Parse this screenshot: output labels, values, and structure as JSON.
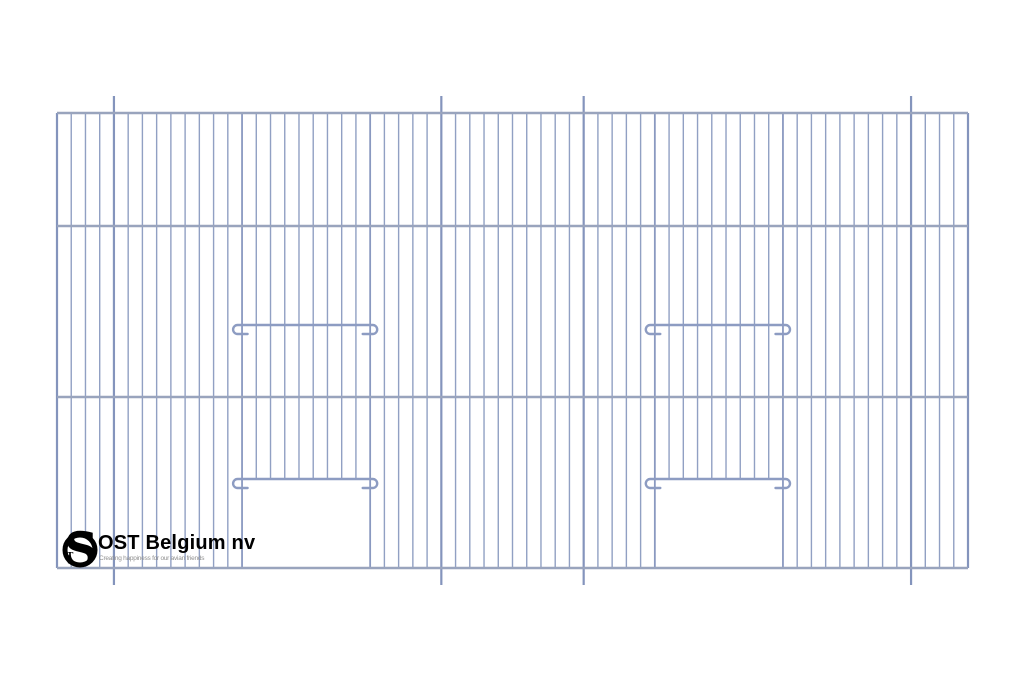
{
  "page": {
    "background": "#ffffff",
    "width": 1024,
    "height": 683
  },
  "logo": {
    "brand": "OST Belgium nv",
    "tagline": "Creating happiness for our avian friends",
    "monogram_letter": "S",
    "monogram_small_letter": "T",
    "text_color": "#000000",
    "tagline_color": "#8f8f8f",
    "ring_color": "#000000"
  },
  "drawing": {
    "type": "cage-front-panel-line-drawing",
    "colors": {
      "mesh_wire": "#91a0c3",
      "frame_edge": "#8494bc",
      "frame_post": "#8494bc",
      "door_edge_wire": "#8a99c0",
      "horizontal_bar": "#99a4bd",
      "hook_bar": "#8d9cc2"
    },
    "frame": {
      "left": 57,
      "right": 968,
      "top": 113,
      "bottom": 568
    },
    "horizontal_bars_y": [
      113,
      226,
      397,
      568
    ],
    "wires": {
      "count": 65,
      "post_indices": [
        4,
        27,
        37,
        60
      ],
      "post_overhang": 17,
      "door_edge_indices": [
        13,
        22,
        42,
        51
      ]
    },
    "doors": [
      {
        "left_wire": 13,
        "right_wire": 22
      },
      {
        "left_wire": 42,
        "right_wire": 51
      }
    ],
    "door_bar_y": 479,
    "hook_bars": [
      {
        "x1": 233.1,
        "x2": 377.2,
        "y": 325,
        "name": "perch-rail-left"
      },
      {
        "x1": 645.8,
        "x2": 790.0,
        "y": 325,
        "name": "perch-rail-right"
      },
      {
        "x1": 233.1,
        "x2": 377.2,
        "y": 479,
        "name": "door-top-bar-left"
      },
      {
        "x1": 645.8,
        "x2": 790.0,
        "y": 479,
        "name": "door-top-bar-right"
      }
    ]
  }
}
